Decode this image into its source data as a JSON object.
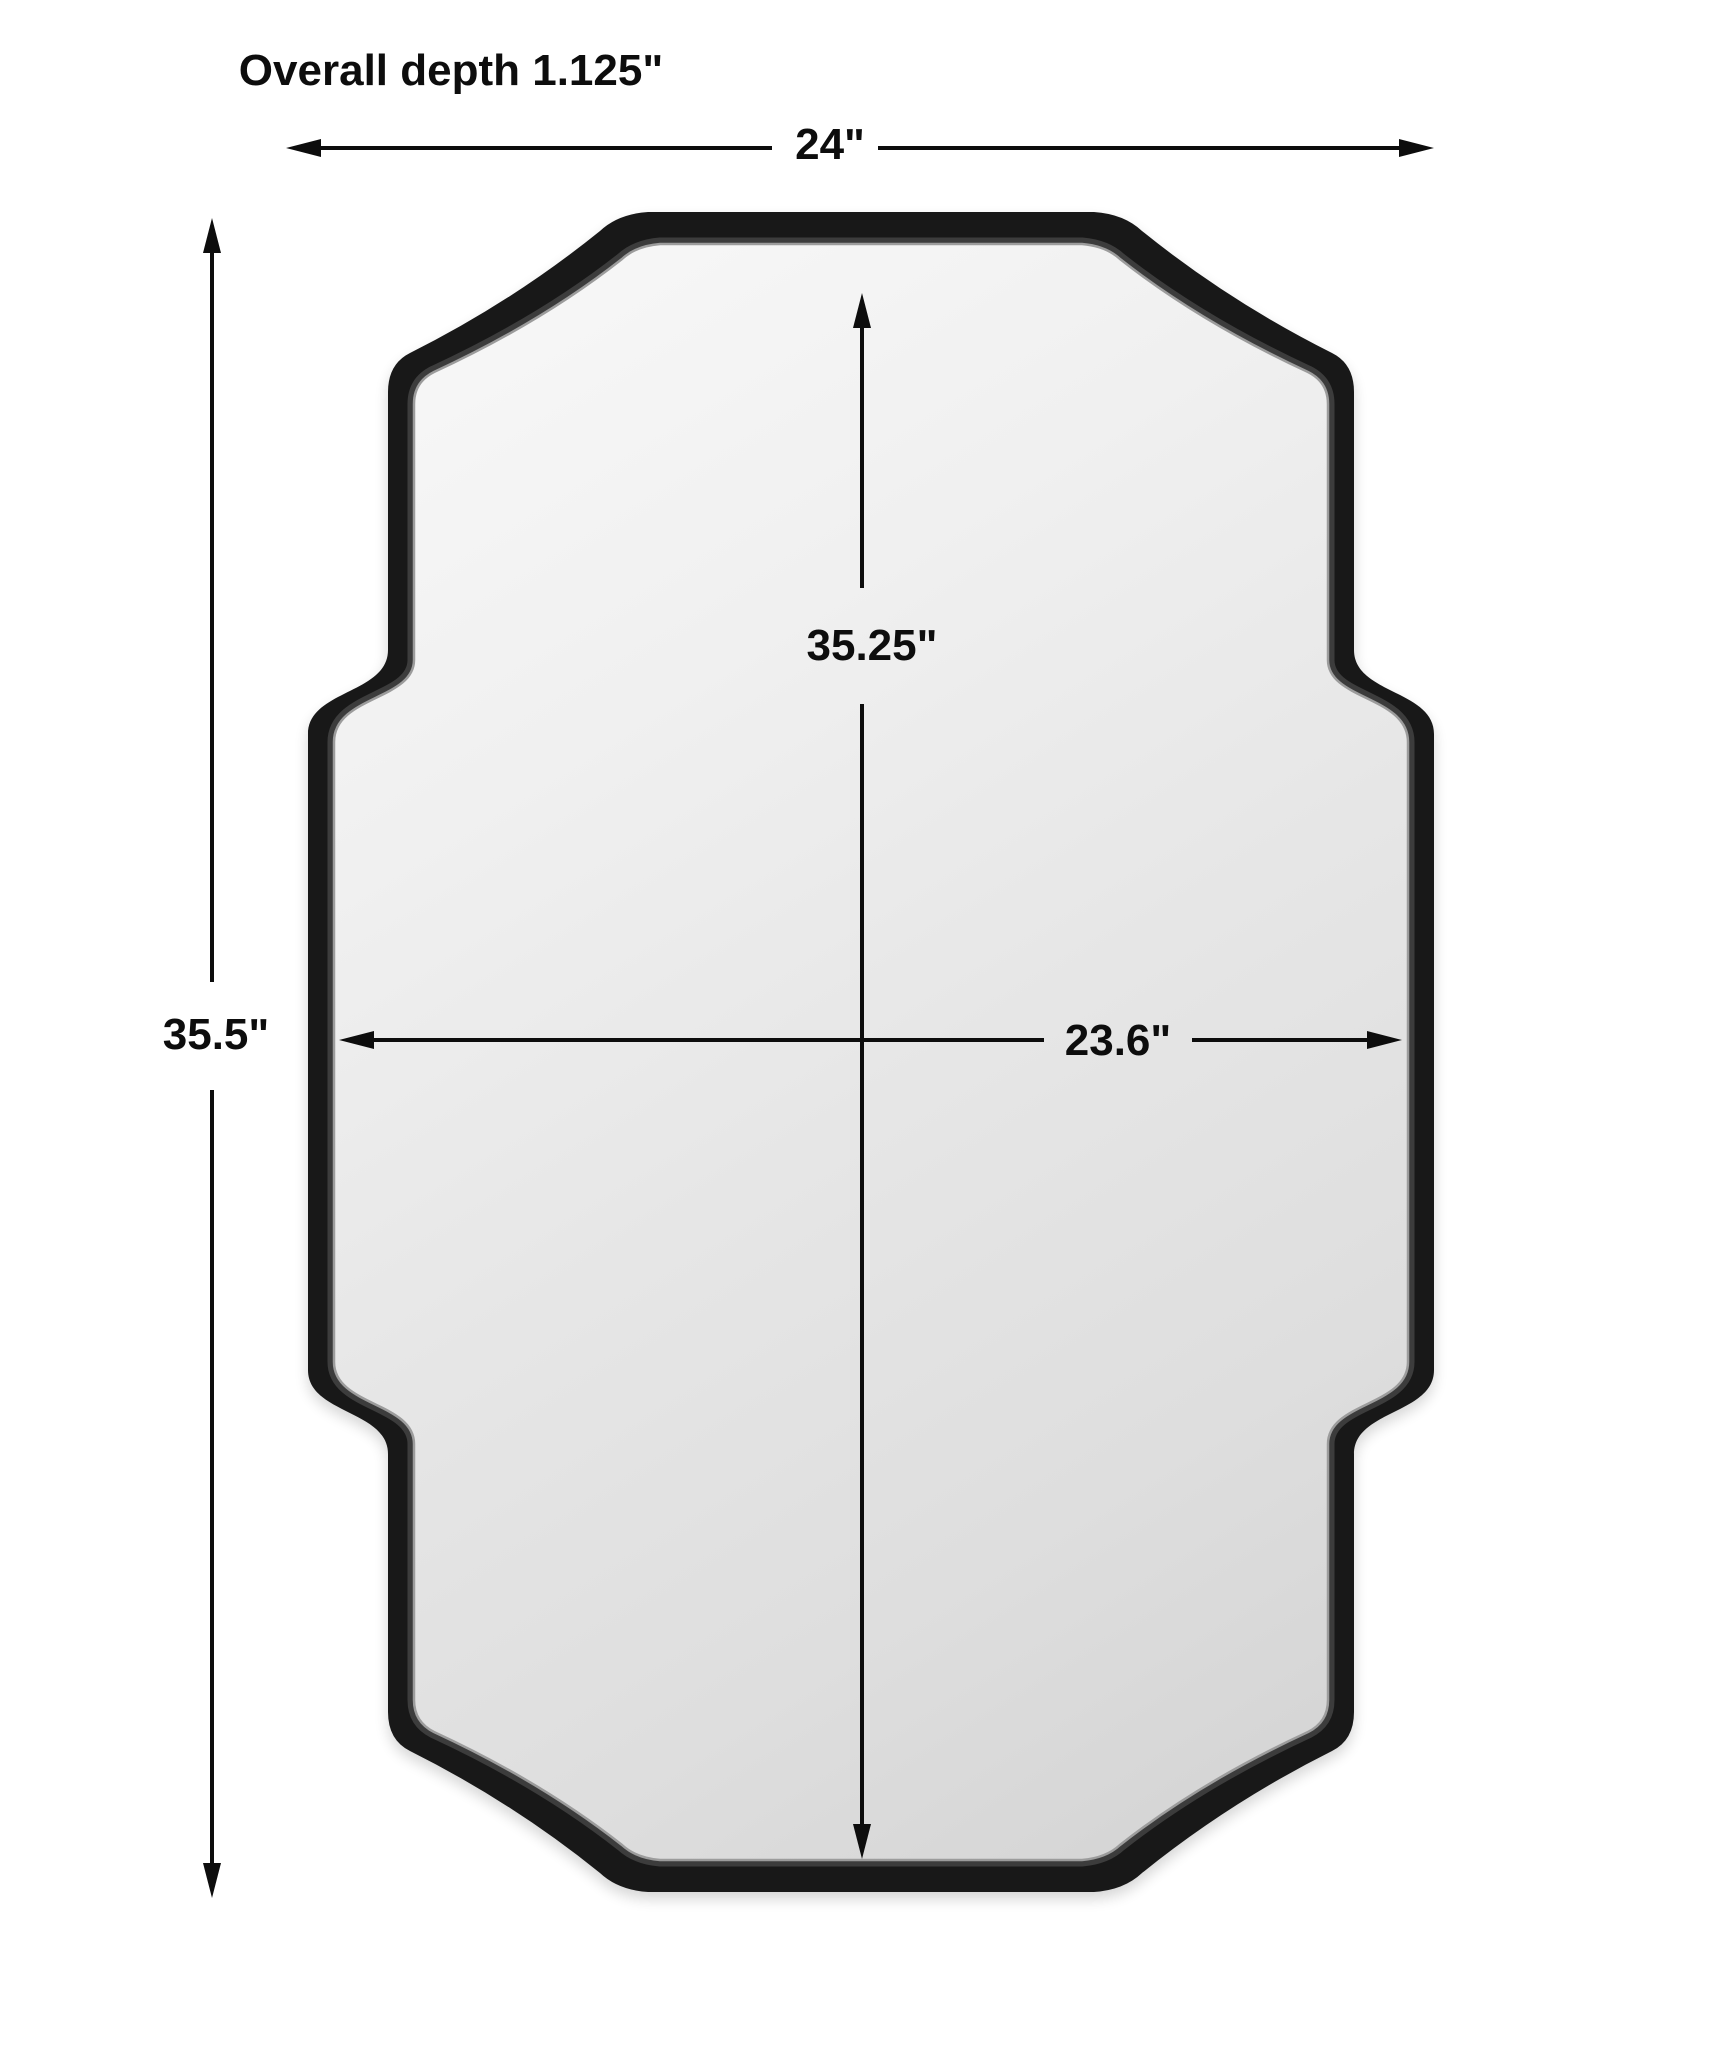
{
  "page": {
    "background": "#ffffff",
    "description": "Dimension diagram of a wall mirror with scalloped notched corners"
  },
  "diagram": {
    "product": "scalloped-corner rectangular wall mirror",
    "frame_color": "#181818",
    "glass_color_light": "#f7f7f7",
    "glass_color_dark": "#d6d6d6",
    "line_color": "#0d0d0d",
    "labels": {
      "depth_note": "Overall depth 1.125\"",
      "overall_width": "24\"",
      "overall_height": "35.5\"",
      "inner_height": "35.25\"",
      "inner_width": "23.6\""
    },
    "dimensions_in": {
      "overall_width": 24,
      "overall_height": 35.5,
      "inner_height": 35.25,
      "inner_width": 23.6,
      "overall_depth": 1.125
    }
  }
}
